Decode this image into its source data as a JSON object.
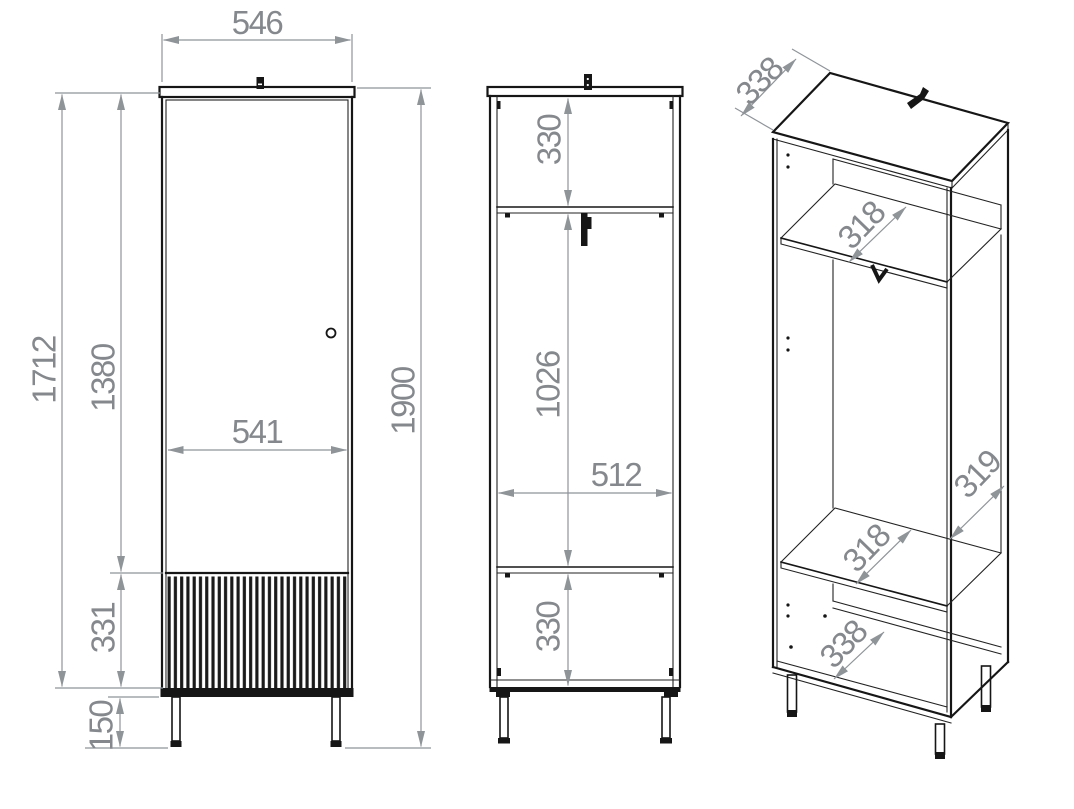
{
  "diagram": {
    "type": "furniture-technical-drawing",
    "colors": {
      "outline": "#161616",
      "dimension_gray": "#8f9499",
      "background": "#ffffff"
    },
    "front_view": {
      "width": "546",
      "door_width": "541",
      "total_height": "1900",
      "body_height": "1712",
      "upper_section_height": "1380",
      "fluted_section_height": "331",
      "leg_height": "150"
    },
    "section_view": {
      "top_compartment_height": "330",
      "middle_compartment_height": "1026",
      "interior_width": "512",
      "bottom_compartment_height": "330"
    },
    "perspective_view": {
      "top_depth": "338",
      "upper_shelf_depth": "318",
      "side_depth": "319",
      "lower_shelf_depth": "318",
      "bottom_depth": "338"
    }
  }
}
